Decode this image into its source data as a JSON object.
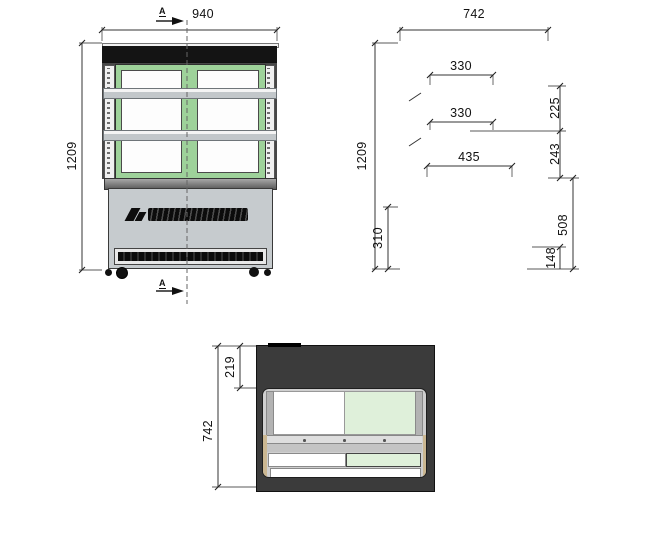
{
  "title": "refrigerated-display-cabinet-technical-drawing",
  "palette": {
    "gasket_green": "#9ed29a",
    "glass_green": "#dff0da",
    "insulation_tan": "#e9d7a5",
    "body_gray": "#c6cbce",
    "frame_black": "#141414",
    "line_color": "#333333"
  },
  "dims": {
    "front": {
      "width": "940",
      "height": "1209",
      "section": "A"
    },
    "side": {
      "width": "742",
      "height": "1209",
      "shelf_top_depth": "330",
      "shelf_mid_depth": "330",
      "deck_depth": "435",
      "gap_upper": "225",
      "gap_lower": "243",
      "machine_height": "310",
      "base_height": "508",
      "caster_height": "148"
    },
    "plan": {
      "top_inset": "219",
      "depth": "742"
    }
  }
}
